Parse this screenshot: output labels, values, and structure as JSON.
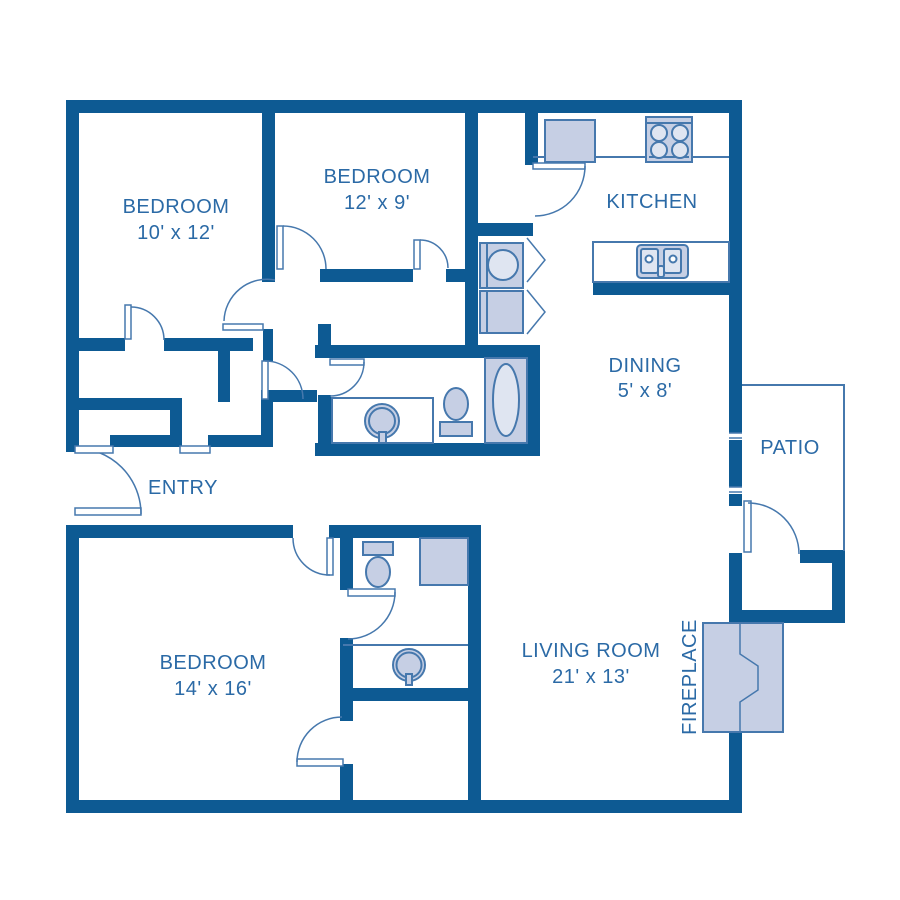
{
  "title": "3 bedroom 2 bath apartment floor plan",
  "palette": {
    "wall": "#0d5a93",
    "line": "#4678ad",
    "fixture_fill": "#c6cfe4",
    "label_text": "#2b6aa6",
    "background": "#ffffff"
  },
  "rooms": {
    "bedroom_top_left": {
      "label": "BEDROOM",
      "dims": "10' x 12'"
    },
    "bedroom_top_middle": {
      "label": "BEDROOM",
      "dims": "12' x 9'"
    },
    "kitchen": {
      "label": "KITCHEN",
      "dims": ""
    },
    "dining": {
      "label": "DINING",
      "dims": "5' x 8'"
    },
    "patio": {
      "label": "PATIO",
      "dims": ""
    },
    "entry": {
      "label": "ENTRY",
      "dims": ""
    },
    "bedroom_bottom": {
      "label": "BEDROOM",
      "dims": "14' x 16'"
    },
    "living_room": {
      "label": "LIVING ROOM",
      "dims": "21' x 13'"
    },
    "fireplace": {
      "label": "FIREPLACE",
      "dims": ""
    }
  },
  "fixtures": [
    "refrigerator",
    "stove",
    "kitchen-double-sink",
    "washer",
    "dryer",
    "bifold-closet-doors",
    "bathtub",
    "toilet",
    "vanity-sink",
    "shower",
    "second-toilet",
    "second-vanity-sink",
    "fireplace"
  ]
}
